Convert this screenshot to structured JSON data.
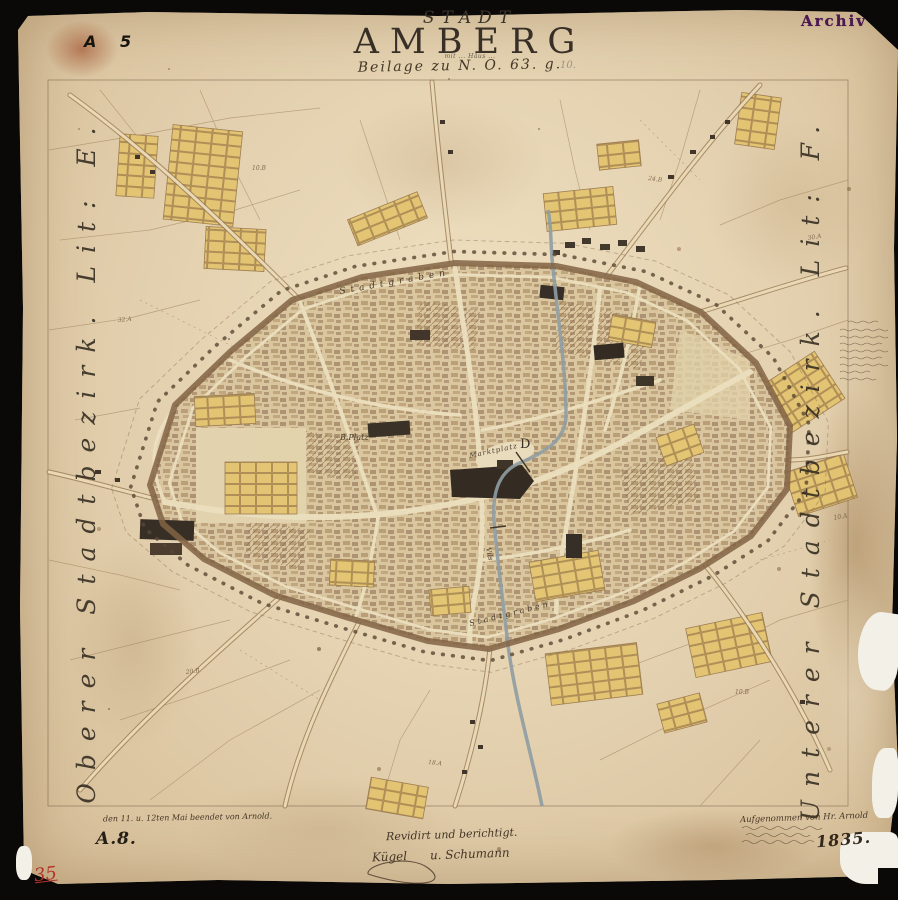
{
  "stamps": {
    "archive": "Archiv",
    "sheet_no": "A 5",
    "inventory_no": "A.8.",
    "red_no": "35"
  },
  "title": {
    "kicker": "STADT",
    "name": "AMBERG",
    "tiny_line": "mit ... Häus ...",
    "subtitle": "Beilage zu N. O. 63. g.",
    "pencil_note": "10."
  },
  "margins": {
    "left_label": "Oberer Stadtbezirk. Lit: E.",
    "right_label": "Unterer Stadtbezirk. Lit: F."
  },
  "map_labels": {
    "stadtgraben_north": "Stadtgraben",
    "stadtgraben_south": "Stadtgraben",
    "marktplatz": "Marktplatz",
    "b_platz": "B.Platz",
    "letter_c": "C",
    "letter_d": "D",
    "river": "Vils"
  },
  "parcels": [
    "32.A",
    "10.B",
    "24.B",
    "30.A",
    "10.B",
    "18.A",
    "20.B",
    "10.A"
  ],
  "notes": {
    "completion": "den 11. u. 12ten Mai beendet von Arnold.",
    "signature_line1": "Revidirt und berichtigt.",
    "signature_line2": "Kügel      u. Schumann",
    "survey_line1": "Aufgenommen von Hr. Arnold",
    "year": "1835."
  },
  "colors": {
    "paper": "#e4d2b2",
    "ink": "#322a20",
    "stamp_purple": "#4b1850",
    "red": "#b23128",
    "plot_yellow": "#e3c470",
    "wall_brown": "#7d5e3f",
    "river_gray": "#8b9aa3"
  }
}
